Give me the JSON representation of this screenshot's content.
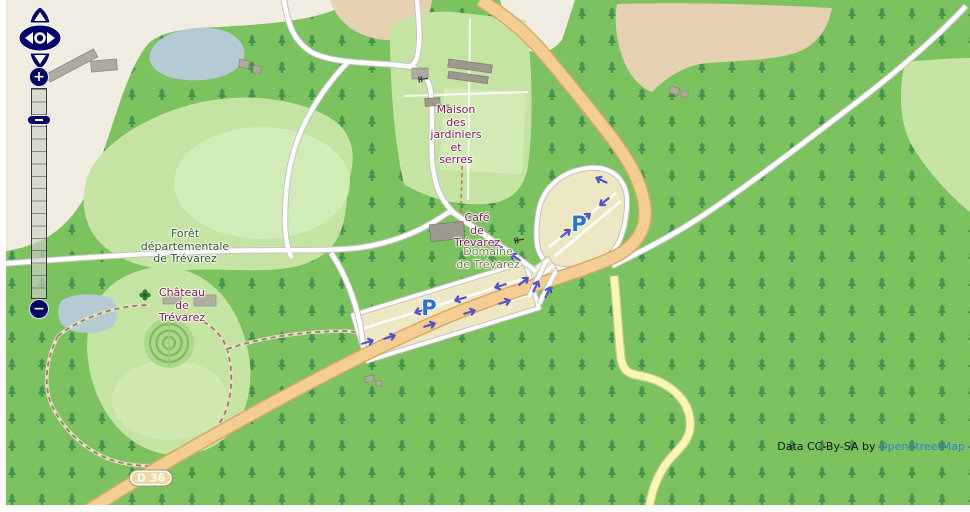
{
  "map": {
    "labels": {
      "forest": {
        "line1": "Forêt",
        "line2": "départementale",
        "line3": "de Trévarez"
      },
      "chateau": {
        "line1": "Château",
        "line2": "de",
        "line3": "Trévarez"
      },
      "maison": {
        "line1": "Maison",
        "line2": "des",
        "line3": "jardiniers",
        "line4": "et",
        "line5": "serres"
      },
      "cafe": {
        "line1": "Café",
        "line2": "de",
        "line3": "Trévarez"
      },
      "domaine": {
        "line1": "Domaine",
        "line2": "de Trévarez"
      }
    },
    "parking_symbol": "P",
    "road_badge": "D 36",
    "attribution": {
      "prefix": "Data CC-By-SA by ",
      "link_text": "OpenStreetMap"
    }
  },
  "controls": {
    "zoom_in_label": "+",
    "zoom_out_label": "−",
    "pan_icons": [
      "pan-up-icon",
      "pan-down-icon",
      "pan-left-icon",
      "pan-right-icon",
      "pan-center-icon"
    ]
  },
  "colors": {
    "forest": "#7CC25F",
    "farm_light": "#F0ECE2",
    "farm_tan": "#E5D0B2",
    "lgreen": "#C5E4A4",
    "lgreen2": "#D5EDBB",
    "water": "#B5CAD3",
    "cream": "#EDE7C3",
    "road_tan": "#F4CD92",
    "road_tan_border": "#D9A967",
    "road_yellow": "#F8F6B3",
    "tree": "#3E8A4C",
    "attraction": "#7E1A4D",
    "forest_label": "#2D5A2D",
    "site_label": "#7B7B49",
    "parking_blue": "#2A72CE",
    "arrow": "#5353C8",
    "navy": "#000066",
    "link": "#2E84C8"
  }
}
